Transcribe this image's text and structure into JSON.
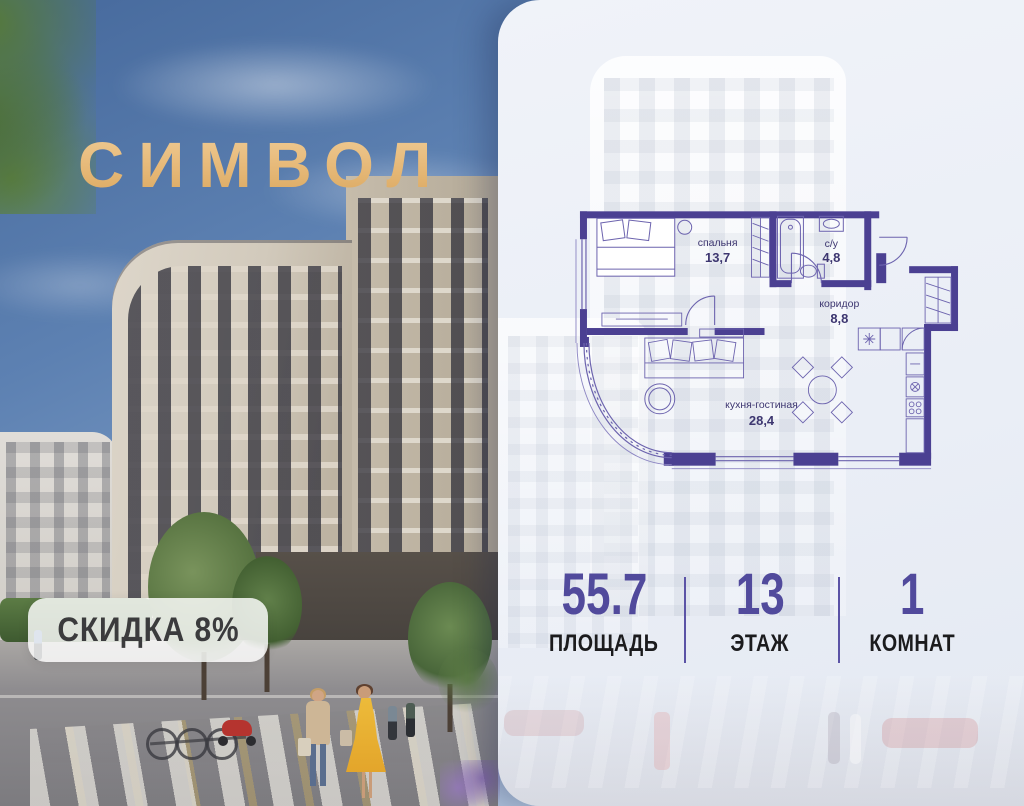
{
  "logo": {
    "text": "СИМВОЛ"
  },
  "badge": {
    "text": "СКИДКА 8%"
  },
  "floor_plan": {
    "rooms": [
      {
        "name": "спальня",
        "area": "13,7"
      },
      {
        "name": "с/у",
        "area": "4,8"
      },
      {
        "name": "коридор",
        "area": "8,8"
      },
      {
        "name": "кухня-гостиная",
        "area": "28,4"
      }
    ]
  },
  "stats": {
    "items": [
      {
        "value": "55.7",
        "label": "ПЛОЩАДЬ"
      },
      {
        "value": "13",
        "label": "ЭТАЖ"
      },
      {
        "value": "1",
        "label": "КОМНАТ"
      }
    ]
  },
  "colors": {
    "accent_purple": "#514a9c",
    "plan_wall": "#4b4092",
    "logo_gold": "#e7bd80"
  }
}
